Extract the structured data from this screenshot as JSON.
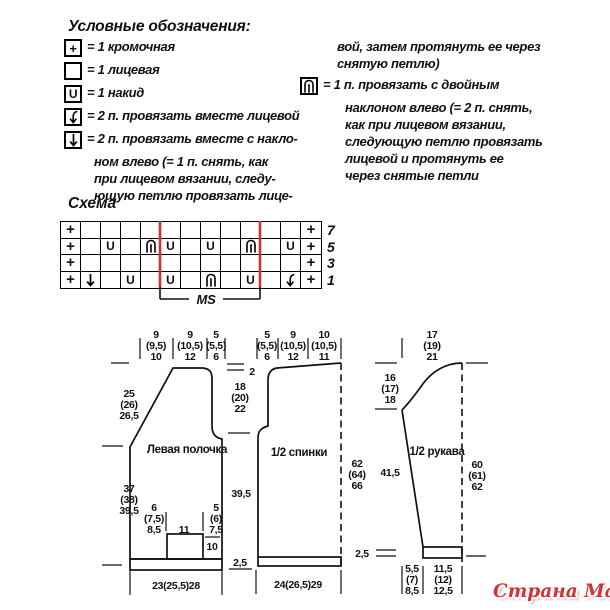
{
  "legend": {
    "title": "Условные обозначения:",
    "items": [
      {
        "symbol": "edge",
        "text": "= 1 кромочная"
      },
      {
        "symbol": "knit",
        "text": "= 1 лицевая"
      },
      {
        "symbol": "yo",
        "text": "= 1 накид"
      },
      {
        "symbol": "k2tog",
        "text": "= 2 п. провязать вместе лицевой"
      },
      {
        "symbol": "ssk",
        "text": "= 2 п. провязать вместе с накло-",
        "cont": [
          "ном влево (= 1 п. снять, как",
          "при лицевом вязании, следу-",
          "ющую петлю провязать лице-"
        ]
      }
    ],
    "right_column": {
      "cont_lines": [
        "вой, затем протянуть ее через",
        "снятую петлю)"
      ],
      "item": {
        "symbol": "cdd",
        "text": "= 1 п. провязать с двойным",
        "cont": [
          "наклоном влево (= 2 п. снять,",
          "как при лицевом вязании,",
          "следующую петлю провязать",
          "лицевой и протянуть ее",
          "через снятые петли"
        ]
      }
    }
  },
  "chart": {
    "title": "Схема",
    "row_labels": [
      "7",
      "5",
      "3",
      "1"
    ],
    "rows": [
      {
        "label": "7",
        "cells": [
          "+",
          "",
          "",
          "",
          "",
          "",
          "",
          "",
          "",
          "",
          "",
          "",
          "+"
        ]
      },
      {
        "label": "5",
        "cells": [
          "+",
          "",
          "U",
          "",
          "cdd",
          "U",
          "",
          "U",
          "",
          "cdd",
          "",
          "U",
          "+"
        ]
      },
      {
        "label": "3",
        "cells": [
          "+",
          "",
          "",
          "",
          "",
          "",
          "",
          "",
          "",
          "",
          "",
          "",
          "+"
        ]
      },
      {
        "label": "1",
        "cells": [
          "+",
          "ssk",
          "",
          "U",
          "",
          "U",
          "",
          "cdd",
          "",
          "U",
          "",
          "k2tog",
          "+"
        ]
      }
    ],
    "repeat_label": "MS",
    "repeat_start_col": 5,
    "repeat_end_col": 10,
    "red_color": "#d43030"
  },
  "schematic": {
    "front": {
      "name": "Левая полочка",
      "top": [
        [
          "9",
          "(9,5)",
          "10"
        ],
        [
          "9",
          "(10,5)",
          "12"
        ],
        [
          "5",
          "(5,5)",
          "6"
        ]
      ],
      "left_upper": [
        "25",
        "(26)",
        "26,5"
      ],
      "left_lower": [
        "37",
        "(38)",
        "39,5"
      ],
      "pocket_left": [
        "6",
        "(7,5)",
        "8,5"
      ],
      "pocket_width": "11",
      "pocket_right": [
        "5",
        "(6)",
        "7,5"
      ],
      "pocket_height": "10",
      "bottom": "23(25,5)28"
    },
    "back": {
      "name": "1/2 спинки",
      "shoulder_drop": "2",
      "top": [
        [
          "5",
          "(5,5)",
          "6"
        ],
        [
          "9",
          "(10,5)",
          "12"
        ],
        [
          "10",
          "(10,5)",
          "11"
        ]
      ],
      "armhole_depth": [
        "18",
        "(20)",
        "22"
      ],
      "side_lower": "39,5",
      "total_height": [
        "62",
        "(64)",
        "66"
      ],
      "hem_height": "2,5",
      "bottom": "24(26,5)29"
    },
    "sleeve": {
      "name": "1/2 рукава",
      "top_width": [
        "17",
        "(19)",
        "21"
      ],
      "cap_height": [
        "16",
        "(17)",
        "18"
      ],
      "seam_length": "41,5",
      "total_length": [
        "60",
        "(61)",
        "62"
      ],
      "cuff_height": "2,5",
      "bottom_left": [
        "5,5",
        "(7)",
        "8,5"
      ],
      "bottom_right": [
        "11,5",
        "(12)",
        "12,5"
      ]
    }
  },
  "watermark": {
    "text": "Страна Мам",
    "color": "#cf3535"
  }
}
